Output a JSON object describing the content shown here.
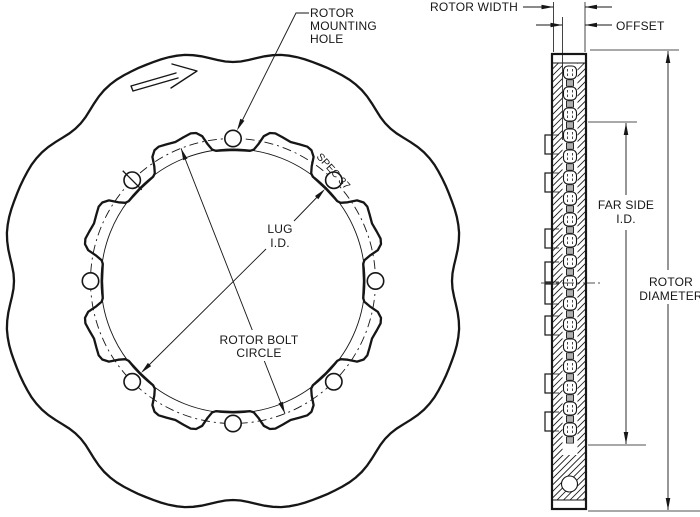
{
  "page": {
    "background": "#ffffff",
    "line_color": "#161616",
    "description": "Technical drawing of scalloped brake rotor, front view and cross-section"
  },
  "front_view": {
    "scallop_lobes": 8,
    "lug_count": 8,
    "mounting_hole_count": 8,
    "labels": {
      "rotor_mounting_hole": {
        "line1": "ROTOR",
        "line2": "MOUNTING",
        "line3": "HOLE"
      },
      "lug_id": {
        "line1": "LUG",
        "line2": "I.D."
      },
      "rotor_bolt_circle": {
        "line1": "ROTOR BOLT",
        "line2": "CIRCLE"
      },
      "spec_marking": "SPEC 37"
    }
  },
  "section_view": {
    "labels": {
      "rotor_width": "ROTOR WIDTH",
      "offset": "OFFSET",
      "far_side_id": {
        "line1": "FAR SIDE",
        "line2": "I.D."
      },
      "rotor_diameter": {
        "line1": "ROTOR",
        "line2": "DIAMETER"
      }
    }
  }
}
